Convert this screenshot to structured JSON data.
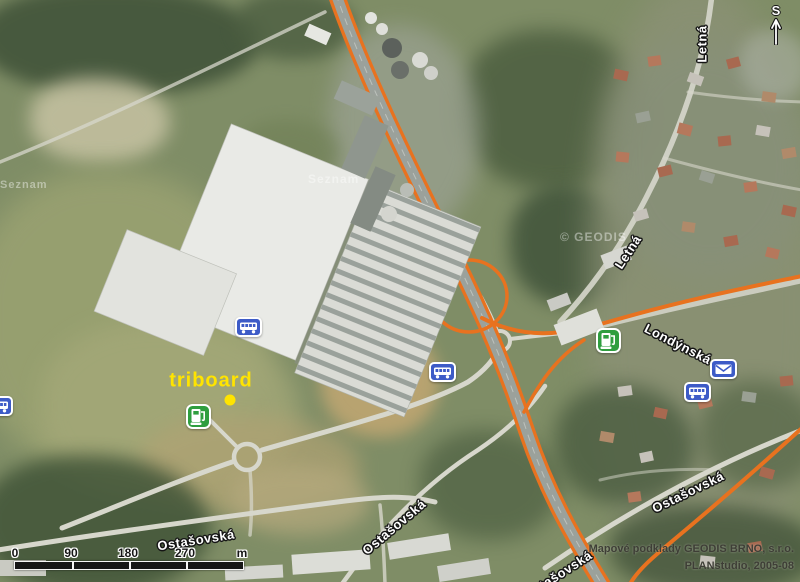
{
  "map": {
    "poi": {
      "label": "triboard"
    },
    "north_label": "S",
    "streets": {
      "letna_top": "Letná",
      "letna_mid": "Letná",
      "londynska": "Londýnská",
      "ostasovska_west": "Ostašovská",
      "ostasovska_center": "Ostašovská",
      "ostasovska_east": "Ostašovská",
      "ostasovska_south": "Ostašovská"
    },
    "watermarks": {
      "seznam_left": "Seznam",
      "seznam_mall": "Seznam",
      "geodis": "© GEODIS"
    },
    "scale_bar": {
      "ticks": [
        "0",
        "90",
        "180",
        "270"
      ],
      "unit": "m"
    },
    "attribution": {
      "line1": "Mapové podklady GEODIS BRNO, s.r.o.",
      "line2": "PLANstudio, 2005-08"
    },
    "icons": {
      "bus": "bus-stop-icon",
      "fuel": "fuel-station-icon",
      "post": "post-office-icon",
      "north_arrow": "north-arrow-icon"
    },
    "colors": {
      "highway_orange": "#e8721f",
      "poi_yellow": "#ffe400",
      "transit_blue": "#3d5bc7",
      "fuel_green": "#2f9e3f"
    }
  }
}
